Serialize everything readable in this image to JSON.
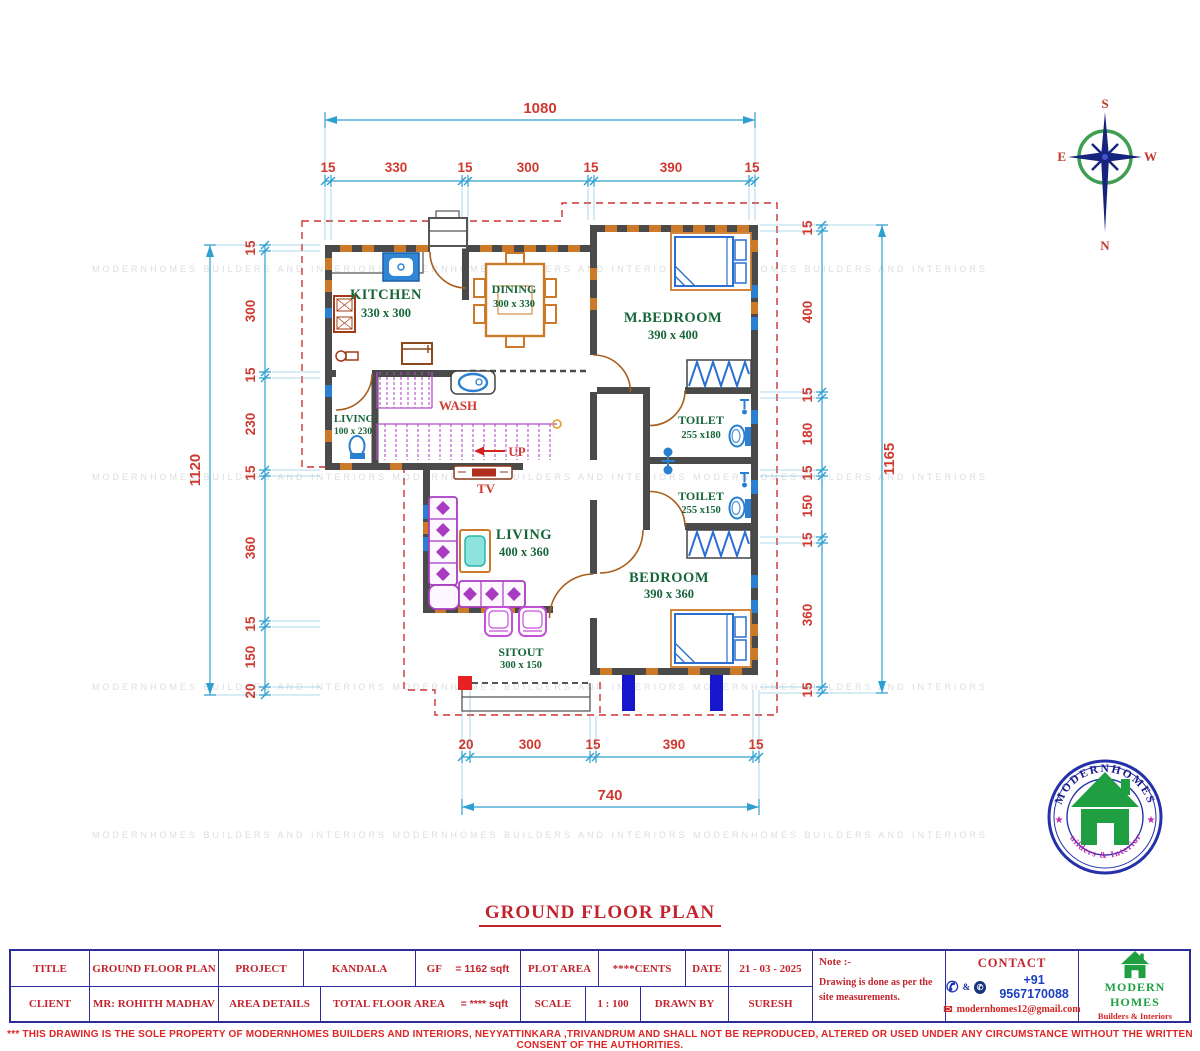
{
  "plan_title": "GROUND FLOOR PLAN",
  "watermark_row": "MODERNHOMES BUILDERS AND INTERIORS      MODERNHOMES BUILDERS AND INTERIORS      MODERNHOMES BUILDERS AND INTERIORS",
  "rooms": {
    "kitchen": {
      "name": "KITCHEN",
      "size": "330 x 300"
    },
    "dining": {
      "name": "DINING",
      "size": "300 x 330"
    },
    "mbedroom": {
      "name": "M.BEDROOM",
      "size": "390 x 400"
    },
    "living_small": {
      "name": "LIVING",
      "size": "100 x 230"
    },
    "toilet1": {
      "name": "TOILET",
      "size": "255 x180"
    },
    "toilet2": {
      "name": "TOILET",
      "size": "255 x150"
    },
    "living": {
      "name": "LIVING",
      "size": "400 x 360"
    },
    "bedroom": {
      "name": "BEDROOM",
      "size": "390 x 360"
    },
    "sitout": {
      "name": "SITOUT",
      "size": "300 x 150"
    },
    "wash": "WASH",
    "tv": "TV",
    "up": "UP"
  },
  "dims": {
    "top_total": "1080",
    "top": [
      "15",
      "330",
      "15",
      "300",
      "15",
      "390",
      "15"
    ],
    "left_total": "1120",
    "left": [
      "15",
      "300",
      "15",
      "230",
      "15",
      "360",
      "15",
      "150",
      "20"
    ],
    "right_total": "1165",
    "right": [
      "15",
      "400",
      "15",
      "180",
      "15",
      "150",
      "15",
      "360",
      "15"
    ],
    "bottom": [
      "20",
      "300",
      "15",
      "390",
      "15"
    ],
    "bottom_total": "740"
  },
  "compass": {
    "n": "N",
    "s": "S",
    "e": "E",
    "w": "W"
  },
  "logo": {
    "top": "MODERNHOMES",
    "bottom": "Builders & Interiors",
    "star": "★"
  },
  "brand": {
    "name": "MODERN HOMES",
    "tagline": "Builders & Interiors"
  },
  "title_block": {
    "title_label": "TITLE",
    "title_value": "GROUND FLOOR PLAN",
    "project_label": "PROJECT",
    "project_value": "KANDALA",
    "gf_label": "GF",
    "gf_value": "= 1162 sqft",
    "plot_area_label": "PLOT AREA",
    "plot_area_value": "****CENTS",
    "date_label": "DATE",
    "date_value": "21 - 03 - 2025",
    "client_label": "CLIENT",
    "client_value": "MR: ROHITH MADHAV",
    "area_details_label": "AREA DETAILS",
    "total_label": "TOTAL FLOOR AREA",
    "total_value": "= **** sqft",
    "scale_label": "SCALE",
    "scale_value": "1 : 100",
    "drawn_by_label": "DRAWN BY",
    "drawn_by_value": "SURESH",
    "note_label": "Note :-",
    "note_text": "Drawing is done as per the site measurements."
  },
  "contact": {
    "heading": "CONTACT",
    "phone_icon": "✆",
    "amp": "&",
    "wa_icon": "✆",
    "phone": "+91 9567170088",
    "mail_icon": "✉",
    "email": "modernhomes12@gmail.com"
  },
  "disclaimer": "*** THIS DRAWING IS THE SOLE PROPERTY OF MODERNHOMES BUILDERS AND INTERIORS, NEYYATTINKARA ,TRIVANDRUM AND SHALL NOT BE REPRODUCED, ALTERED OR USED UNDER ANY CIRCUMSTANCE WITHOUT THE WRITTEN CONSENT OF THE AUTHORITIES."
}
